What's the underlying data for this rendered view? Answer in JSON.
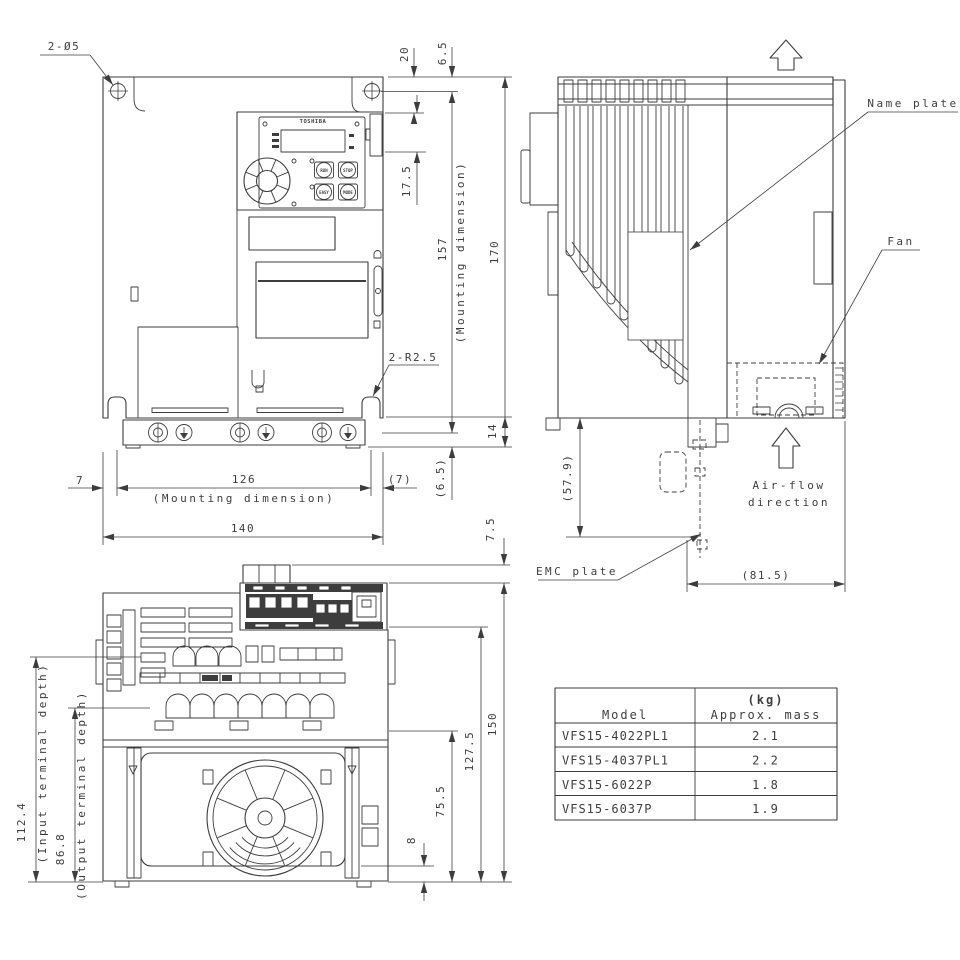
{
  "front_view": {
    "callout_holes": "2-Ø5",
    "callout_radius": "2-R2.5",
    "keypad": {
      "brand": "TOSHIBA",
      "btn_run": "RUN",
      "btn_stop": "STOP",
      "btn_easy": "EASY",
      "btn_mode": "MODE"
    },
    "dims": {
      "top_offset": "20",
      "hole_offset": "6.5",
      "display": "17.5",
      "mount_h": "157",
      "mount_h_note": "(Mounting dimension)",
      "total_h": "170",
      "strip": "14",
      "bottom_offset": "(6.5)",
      "left": "7",
      "mount_w": "126",
      "mount_w_note": "(Mounting dimension)",
      "right": "(7)",
      "total_w": "140"
    }
  },
  "side_view": {
    "labels": {
      "name_plate": "Name plate",
      "fan": "Fan",
      "emc_plate": "EMC plate",
      "airflow1": "Air-flow",
      "airflow2": "direction"
    },
    "dims": {
      "emc_depth": "(57.9)",
      "body_depth": "(81.5)"
    }
  },
  "bottom_view": {
    "dims": {
      "protrusion": "7.5",
      "input_depth": "112.4",
      "input_depth_note": "(Input terminal depth)",
      "output_depth": "86.8",
      "output_depth_note": "(Output terminal depth)",
      "total": "150",
      "cover": "127.5",
      "fan": "75.5",
      "gap": "8"
    }
  },
  "mass_table": {
    "header_model": "Model",
    "header_kg": "(kg)",
    "header_mass": "Approx. mass",
    "rows": [
      {
        "model": "VFS15-4022PL1",
        "mass": "2.1"
      },
      {
        "model": "VFS15-4037PL1",
        "mass": "2.2"
      },
      {
        "model": "VFS15-6022P",
        "mass": "1.8"
      },
      {
        "model": "VFS15-6037P",
        "mass": "1.9"
      }
    ]
  },
  "colors": {
    "line": "#3d3d3d",
    "background": "#ffffff"
  }
}
